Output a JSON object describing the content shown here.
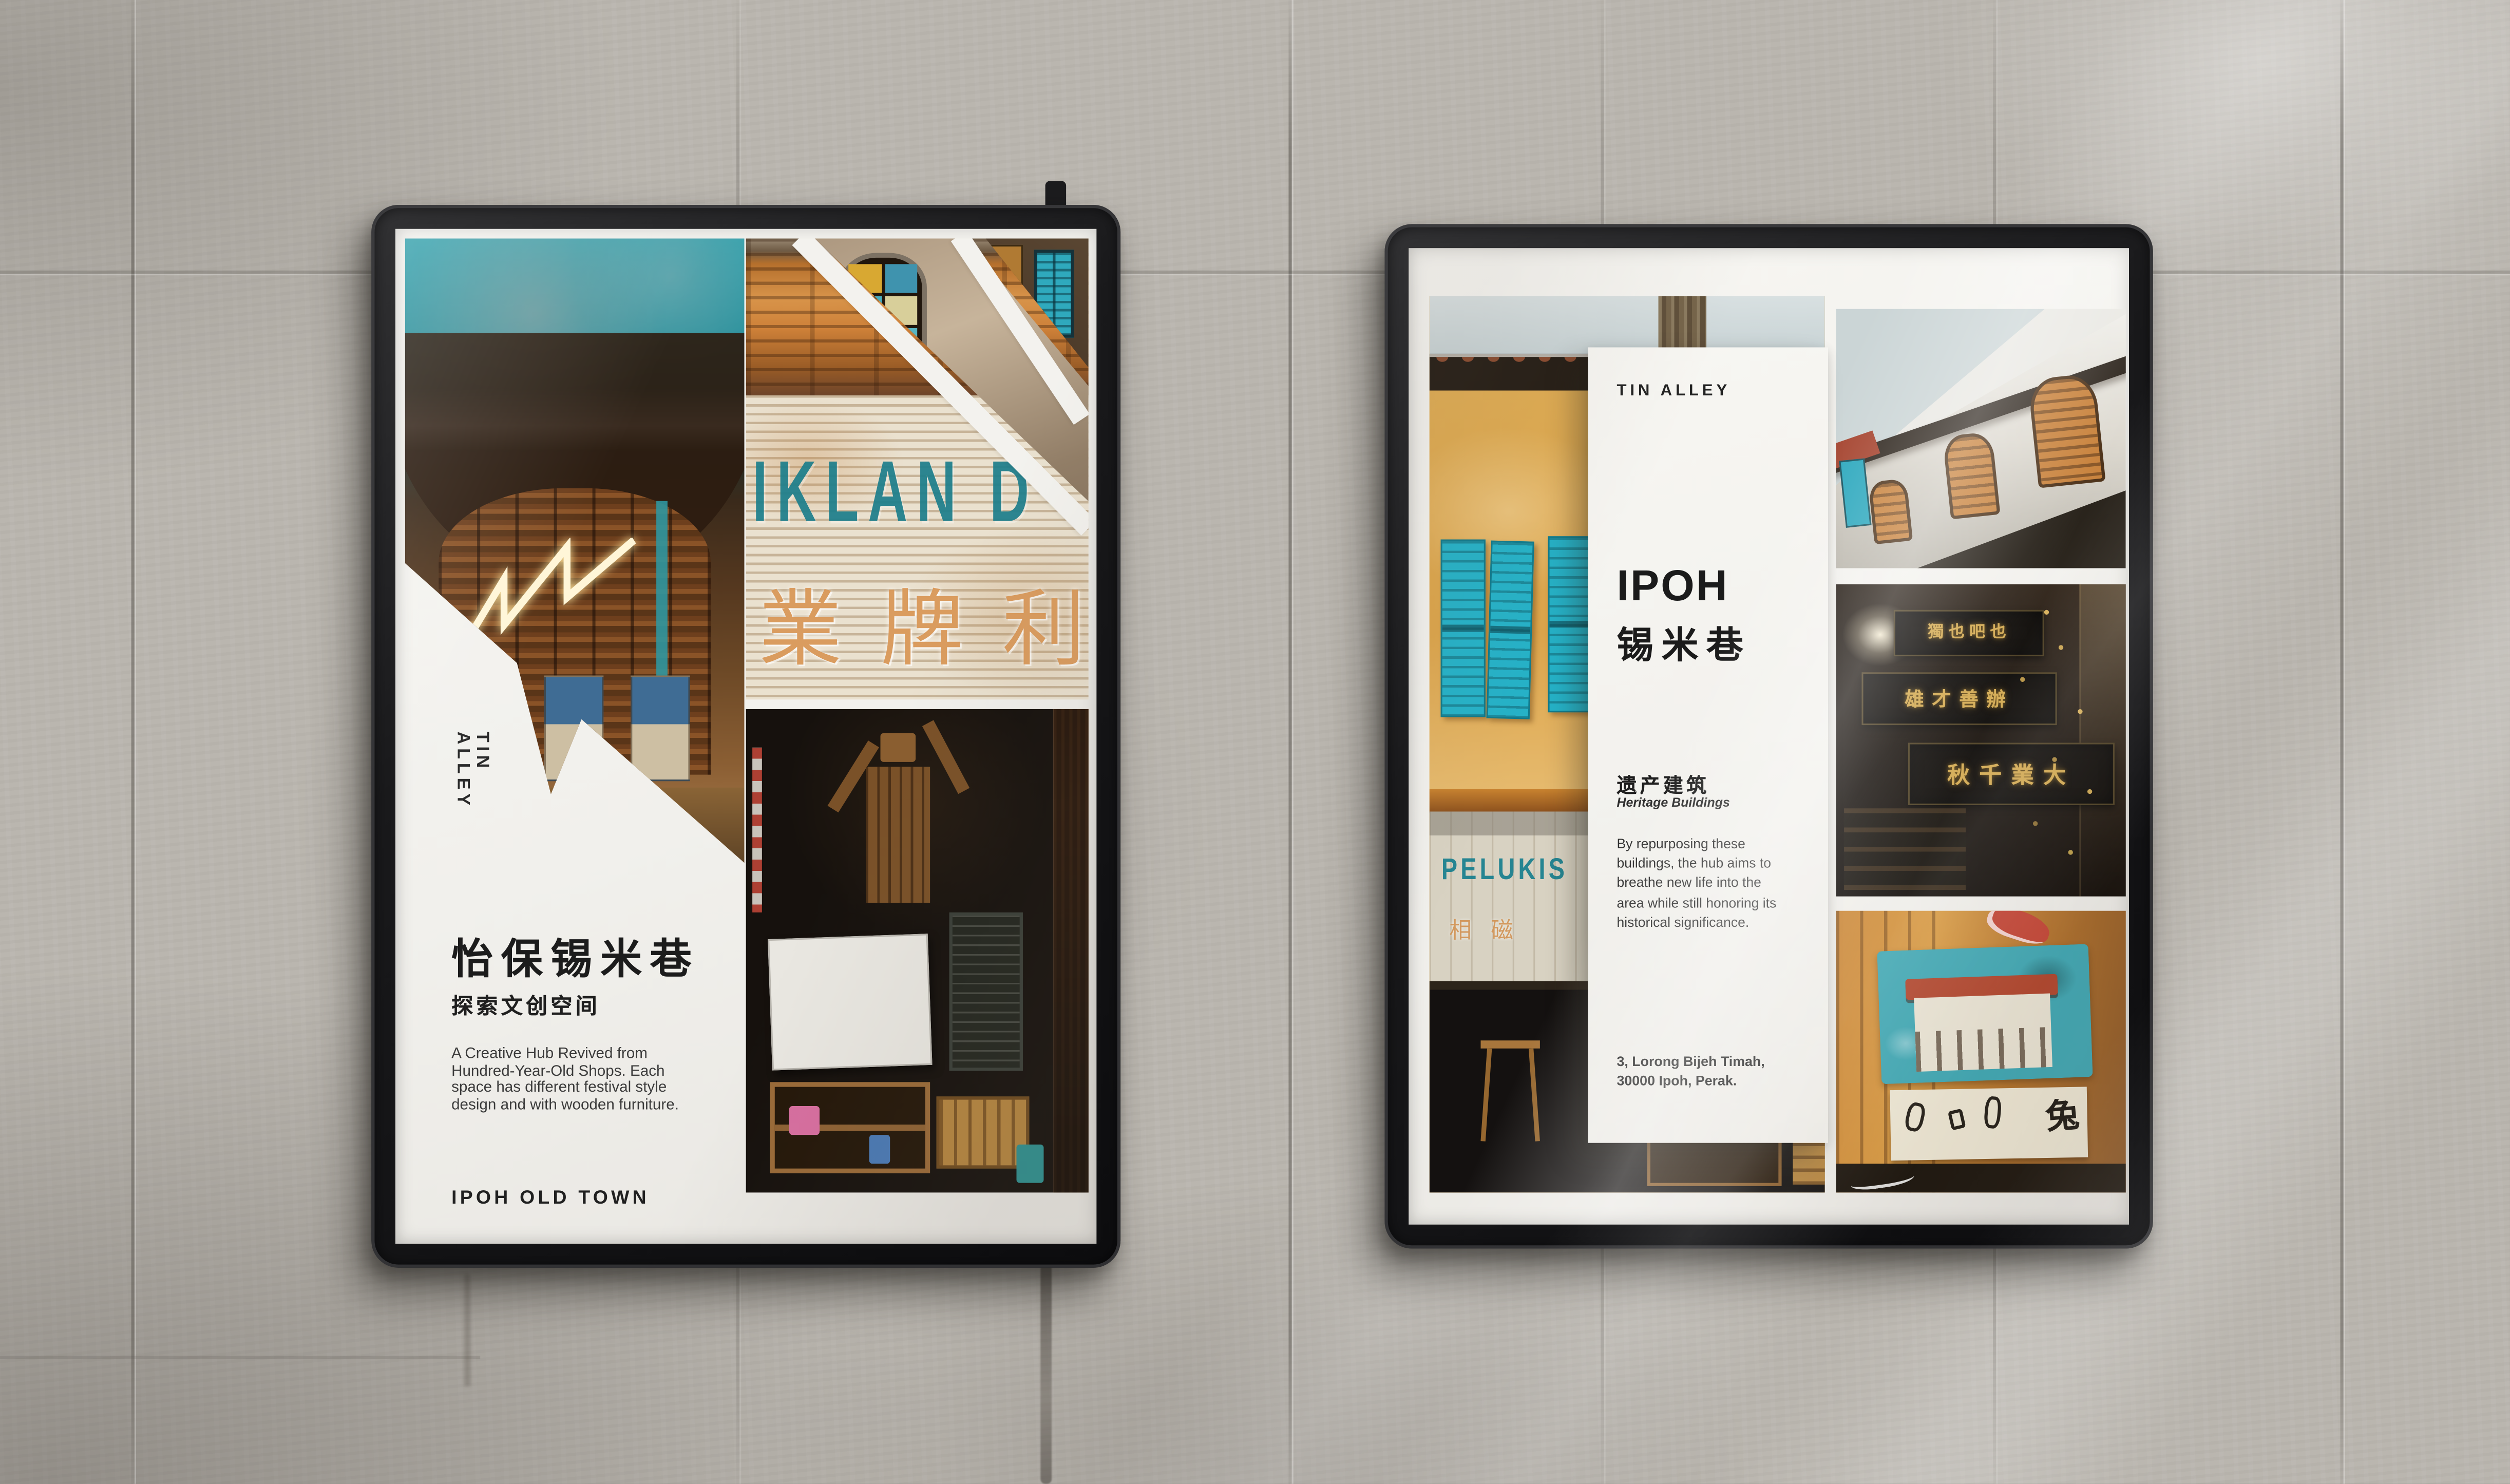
{
  "scene": {
    "description": "Two black rounded-corner poster frames mounted on a weathered concrete tile wall with diagonal sunlight from the top right",
    "wall_color": "#bab6af",
    "frame_color": "#1a1a1c",
    "paper_color": "#f3f2ee"
  },
  "left_poster": {
    "vertical_label": "TIN ALLEY",
    "title_zh": "怡保锡米巷",
    "subtitle_zh": "探索文创空间",
    "body": "A Creative Hub Revived from Hundred-Year-Old Shops. Each space has different festival style design and with wooden furniture.",
    "footer": "IPOH OLD TOWN",
    "photo_texts": {
      "shutter_sign_latin": "IKLAN D",
      "shutter_sign_zh": "業牌利"
    }
  },
  "right_poster": {
    "brand": "TIN ALLEY",
    "title_latin": "IPOH",
    "title_zh": "锡米巷",
    "section_zh": "遗产建筑",
    "section_en": "Heritage Buildings",
    "body": "By repurposing these buildings, the hub aims to breathe new life into the area while still honoring its historical significance.",
    "address_line1": "3, Lorong Bijeh Timah,",
    "address_line2": "30000 Ipoh, Perak.",
    "photo_texts": {
      "shop_sign_latin": "PELUKIS",
      "shop_sign_zh": "相磁",
      "signboard_top_zh": "獨也吧也",
      "signboard_mid_zh": "雄才善辦",
      "signboard_bottom_zh": "秋千業大",
      "mural_zh": "兔"
    }
  },
  "colors": {
    "accent_teal": "#1e7f8c",
    "shutter_teal": "#25b2c8",
    "accent_orange": "#d8924a",
    "signboard_gold": "#d2a84e"
  }
}
